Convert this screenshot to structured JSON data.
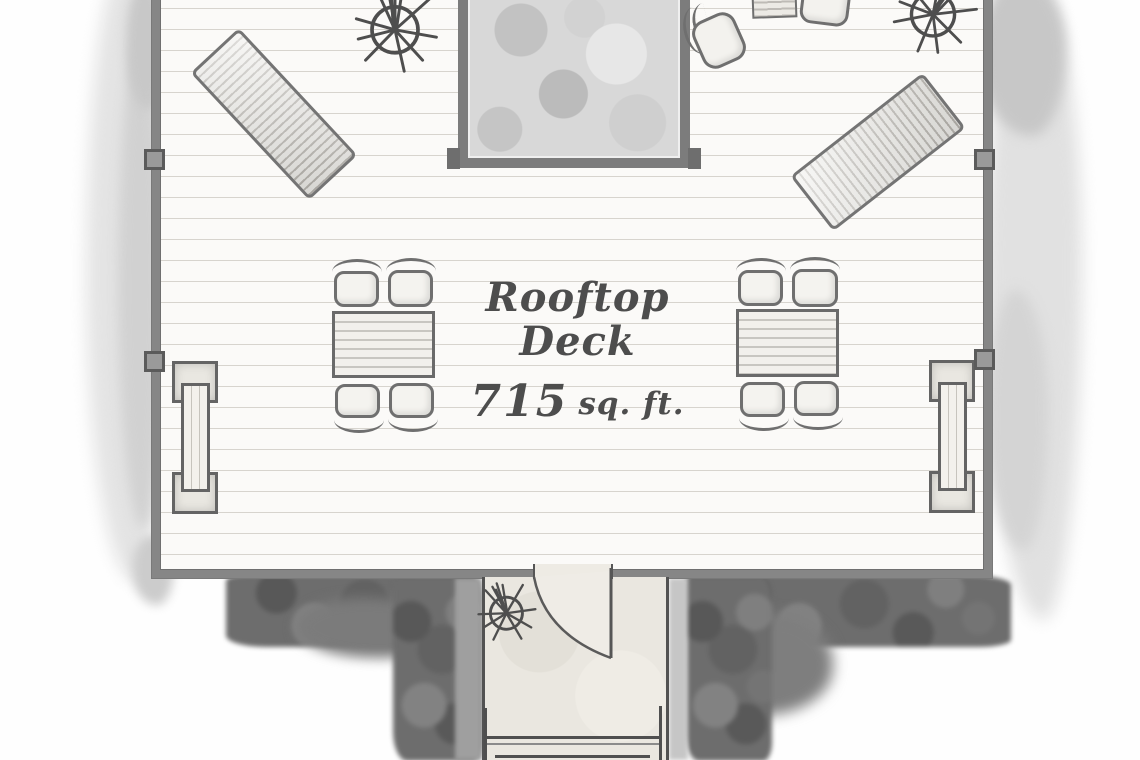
{
  "plan": {
    "label": {
      "line1": "Rooftop",
      "line2": "Deck",
      "area_value": "715",
      "area_unit": "sq. ft."
    },
    "colors": {
      "wall": "#868686",
      "wall_edge": "#5e5e5e",
      "deck_floor": "#fbfaf8",
      "plank_line": "#d7d4ce",
      "roof_shadow": "#6d6d6d",
      "watercolor_wash": "#e2e2e2",
      "stairwell_floor": "#eae7e0",
      "skylight_fill": "#d8d8d8",
      "furniture_outline": "#6f6f6f",
      "furniture_fill": "#f3f2ee",
      "label_ink": "#4d4d4d"
    },
    "icons": {
      "plant": "spoke-circle-plant-icon",
      "door": "quarter-arc-door-swing-icon",
      "stairs": "landing-with-rails-icon"
    },
    "furniture": {
      "lounge_chair_left": "lounge chair",
      "lounge_chair_right": "lounge chair",
      "dining_set_left": "table with 4 chairs",
      "dining_set_right": "table with 4 chairs",
      "bench_left": "bench with end tables",
      "bench_right": "bench with end tables",
      "bistro_set_top": "2 chairs with side table",
      "skylight": "roof opening",
      "stairwell": "stair access with door"
    }
  }
}
